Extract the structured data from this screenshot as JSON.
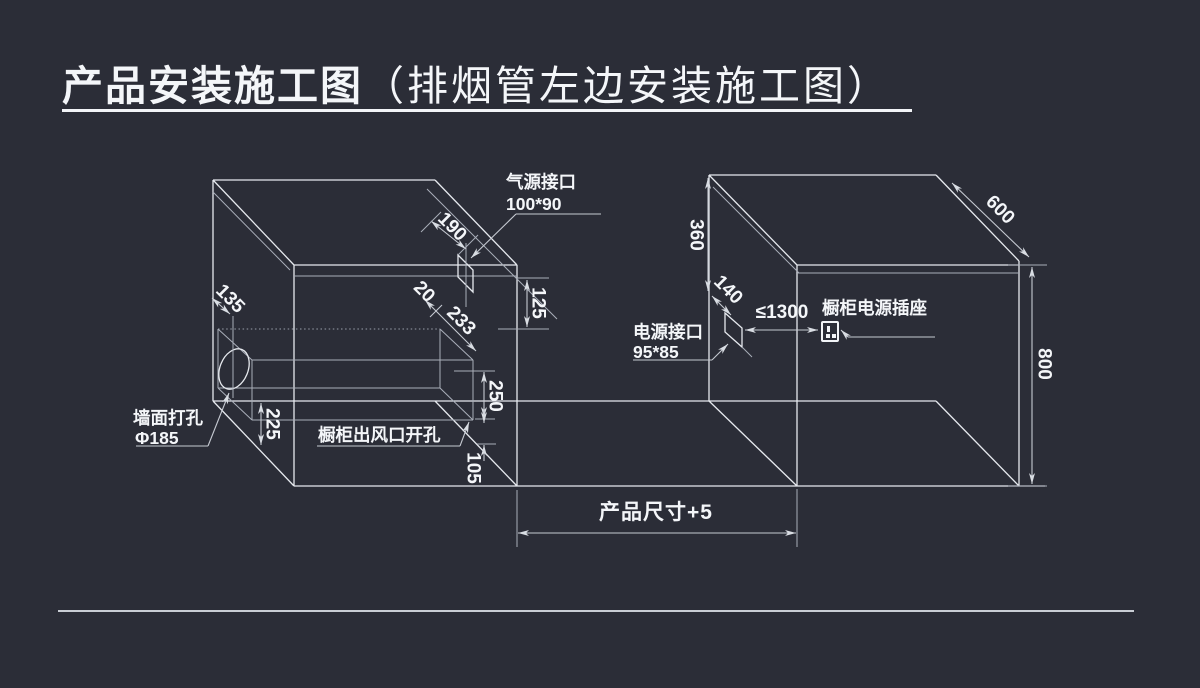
{
  "title": {
    "main": "产品安装施工图",
    "sub": "（排烟管左边安装施工图）"
  },
  "left_figure": {
    "gas_interface_label": "气源接口",
    "gas_interface_size": "100*90",
    "wall_hole_label": "墙面打孔",
    "wall_hole_size": "Φ185",
    "air_outlet_label": "橱柜出风口开孔",
    "dim_wall_to_hole": "135",
    "dim_gas_offset": "190",
    "dim_front_gap": "20",
    "dim_duct_depth": "233",
    "dim_top_drop": "125",
    "dim_hole_height": "225",
    "dim_outlet_height": "250",
    "dim_bottom_gap": "105"
  },
  "right_figure": {
    "power_interface_label": "电源接口",
    "power_interface_size": "95*85",
    "socket_label": "橱柜电源插座",
    "dim_socket_distance": "≤1300",
    "dim_top_to_power": "360",
    "dim_power_offset": "140",
    "dim_depth": "600",
    "dim_height": "800"
  },
  "footer_dimension": "产品尺寸+5",
  "icons": {
    "socket": "power-socket-icon"
  },
  "colors": {
    "background": "#2b2d37",
    "line": "#e6e9ee",
    "dim_line": "#c6cad2",
    "text": "#f4f6f9"
  }
}
